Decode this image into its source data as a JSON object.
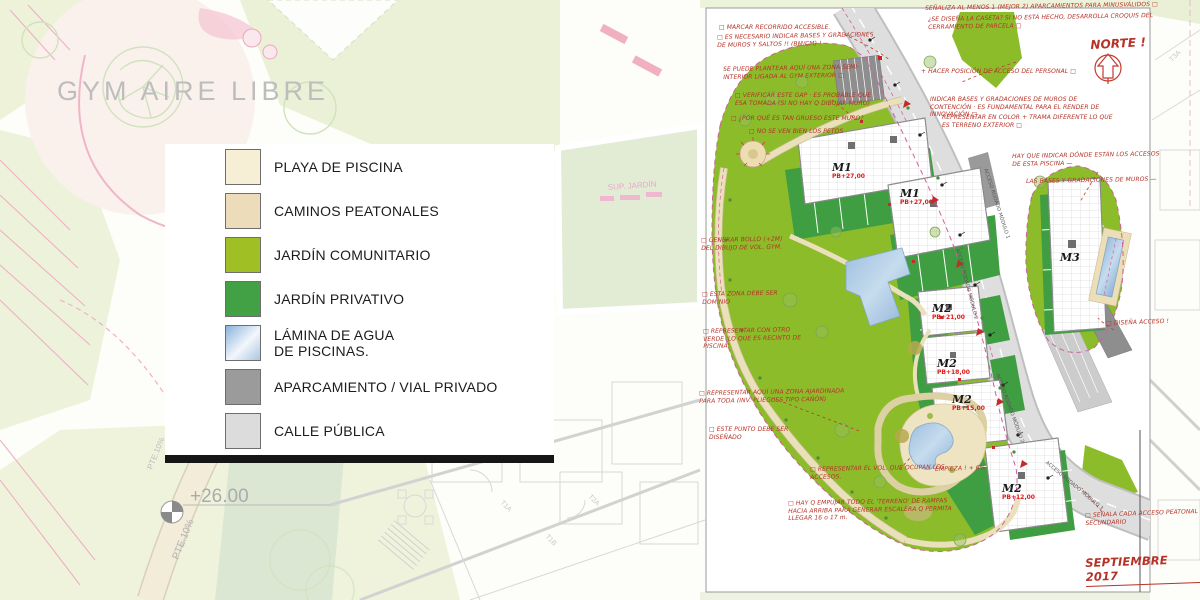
{
  "legend": {
    "items": [
      {
        "label": "PLAYA DE PISCINA",
        "color": "#f6eed5"
      },
      {
        "label": "CAMINOS PEATONALES",
        "color": "#ecdcba"
      },
      {
        "label": "JARDÍN COMUNITARIO",
        "color": "#9fbf25"
      },
      {
        "label": "JARDÍN PRIVATIVO",
        "color": "#43a145"
      },
      {
        "label": "LÁMINA DE AGUA DE PISCINAS.",
        "color": "linear-gradient(135deg,#8ab2dc 0%,#f2f7fb 55%,#a9c6e2 100%)"
      },
      {
        "label": "APARCAMIENTO / VIAL PRIVADO",
        "color": "#9b9b9b"
      },
      {
        "label": "CALLE PÚBLICA",
        "color": "#dcdcdc"
      }
    ]
  },
  "background": {
    "gym_label": "GYM AIRE LIBRE",
    "level_label": "+26.00",
    "slope_label": "PTE.10%",
    "slope_label_2": "PTE.10%",
    "sup_jardin_label": "SUP. JARDÍN",
    "unit_labels": [
      "T1A",
      "T1B",
      "T2A",
      "T3A"
    ]
  },
  "plan": {
    "north_label": "NORTE !",
    "date_label": "SEPTIEMBRE 2017",
    "buildings": [
      {
        "name": "M1",
        "level": "PB+27,00"
      },
      {
        "name": "M1",
        "level": "PB+27,00"
      },
      {
        "name": "M2",
        "level": "PB+21,00"
      },
      {
        "name": "M2",
        "level": "PB+18,00"
      },
      {
        "name": "M2",
        "level": "PB+15,00"
      },
      {
        "name": "M2",
        "level": "PB+12,00"
      },
      {
        "name": "M3",
        "level": ""
      }
    ],
    "road_labels": [
      "ACCESO RODADO MÓDULO 1",
      "ACCESO RODADO MÓDULO 2",
      "ACCESO RODADO MÓDULO 2",
      "ACCESO RODADO MÓDULO 3"
    ],
    "annotations": [
      {
        "text": "□ MARCAR RECORRIDO ACCESIBLE."
      },
      {
        "text": "□ ES NECESARIO INDICAR BASES Y GRADACIONES DE MUROS Y SALTOS !! (BM/CM) !"
      },
      {
        "text": "SE PUEDE PLANTEAR AQUÍ UNA ZONA SEMI-INTERIOR LIGADA AL GYM EXTERIOR □"
      },
      {
        "text": "□ VERIFICAR ESTE GAP · ES PROBABLE QUE ESA TOMADA (SI NO HAY Q DIBUJAR MURO)"
      },
      {
        "text": "□ ¿POR QUÉ ES TAN GRUESO ESTE MURO?"
      },
      {
        "text": "□ NO SE VEN BIEN LOS PETOS"
      },
      {
        "text": "□ GENERAR BOLLO (+2M) DEL DIBUJO DE VOL. GYM."
      },
      {
        "text": "□ ESTA ZONA DEBE SER DOMINIO"
      },
      {
        "text": "□ REPRESENTAR CON OTRO VERDE 'LO QUE ES RECINTO DE PISCINA'"
      },
      {
        "text": "□ REPRESENTAR AQUÍ UNA ZONA AJARDINADA PARA TODA (INV. PLIEGUES TIPO CAÑÓN)"
      },
      {
        "text": "□ ESTE PUNTO DEBE SER DISEÑADO"
      },
      {
        "text": "□ REPRESENTAR EL VOL. QUE OCUPAN LOS ACCESOS."
      },
      {
        "text": "□ HAY Q EMPUJAR TODO EL 'TERRENO' DE RAMPAS HACIA ARRIBA PARA GENERAR ESCALERA Q PERMITA LLEGAR 16 o 17 m."
      },
      {
        "text": "SEÑALIZA AL MENOS 1 (MEJOR 2) APARCAMIENTOS PARA MINUSVÁLIDOS □"
      },
      {
        "text": "¿SE DISEÑA LA CASETA? SI NO ESTÁ HECHO, DESARROLLA CROQUIS DEL CERRAMIENTO DE PARCELA □"
      },
      {
        "text": "+ HACER POSICIÓN DE ACCESO DEL PERSONAL □"
      },
      {
        "text": "INDICAR BASES Y GRADACIONES DE MUROS DE CONTENCIÓN · ES FUNDAMENTAL PARA EL RENDER DE INNOVACIÓN □"
      },
      {
        "text": "REPRESENTAR EN COLOR + TRAMA DIFERENTE LO QUE ES TERRENO EXTERIOR □"
      },
      {
        "text": "HAY QUE INDICAR DÓNDE ESTÁN LOS ACCESOS DE ESTA PISCINA —"
      },
      {
        "text": "LAS BASES Y GRADACIONES DE MUROS —"
      },
      {
        "text": "□ DISEÑA ACCESO !"
      },
      {
        "text": "□ SEÑALA CADA ACCESO PEATONAL SECUNDARIO"
      },
      {
        "text": "EMPIEZA ! + 6%"
      }
    ]
  },
  "colors": {
    "annotation_red": "#b63227",
    "plan_green_communal": "#8cbc2a",
    "plan_green_private": "#3f9e42",
    "street_gray": "#d6d6d6",
    "parking_gray": "#8e8e8e",
    "path_tan": "#e9ddb6",
    "pool_blue": "#a9c7e4",
    "boundary_magenta": "#cf5f9f",
    "bg_pale_green": "#ebf1d6",
    "bg_pink": "#f0b6c8",
    "bg_gray_text": "#bdbdbd"
  }
}
